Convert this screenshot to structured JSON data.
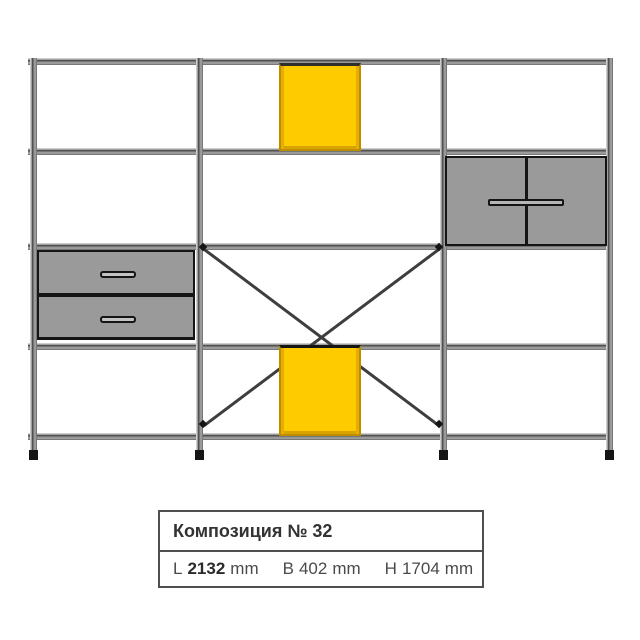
{
  "label_box": {
    "title": "Композиция № 32",
    "dims": [
      {
        "prefix": "L",
        "value": "2132",
        "unit": "mm"
      },
      {
        "prefix": "B",
        "value": "402",
        "unit": "mm"
      },
      {
        "prefix": "H",
        "value": "1704",
        "unit": "mm"
      }
    ]
  },
  "diagram": {
    "kind": "wall-shelving-composition-drawing",
    "bays": 3,
    "shelf_levels": 5,
    "components": [
      "yellow-box-module-upper-center",
      "two-door-cabinet-right",
      "two-drawer-module-left",
      "x-cross-braces-center-bay",
      "yellow-box-module-lower-center"
    ]
  },
  "colors": {
    "accent_yellow": "#FECB00",
    "accent_yellow_edge": "#BD8F00",
    "panel_gray": "#9A9A9A",
    "frame_dark": "#3E3E3E",
    "outline_black": "#151515",
    "text": "#3D3D3D",
    "card_border": "#4F4F4F",
    "background": "#FFFFFF"
  }
}
